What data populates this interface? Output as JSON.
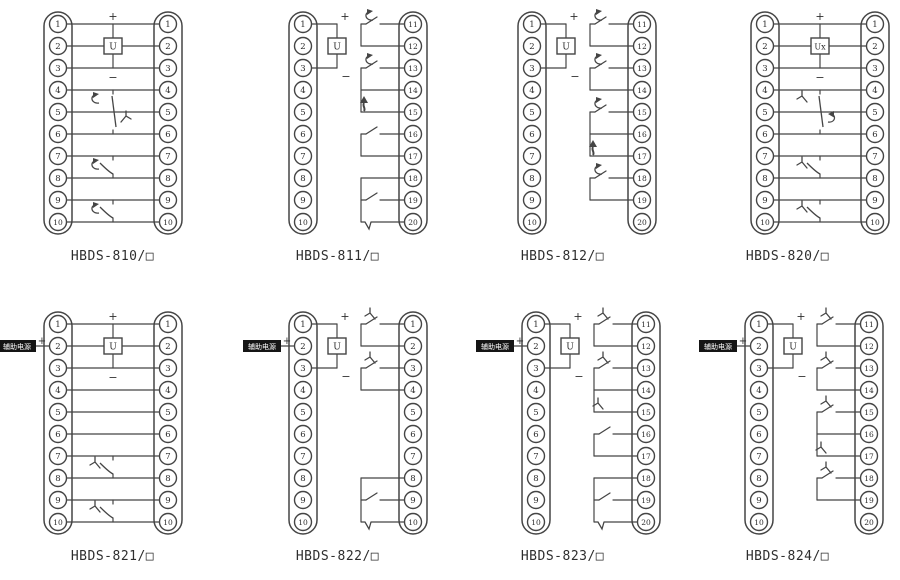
{
  "page": {
    "background": "#ffffff",
    "line_color": "#454545",
    "label_bg": "#151515",
    "label_fg": "#ffffff"
  },
  "diagrams": [
    {
      "title": "HBDS-810/□",
      "layout": "through",
      "x_shift": 0,
      "left_terminals": [
        "1",
        "2",
        "3",
        "4",
        "5",
        "6",
        "7",
        "8",
        "9",
        "10"
      ],
      "right_terminals": [
        "1",
        "2",
        "3",
        "4",
        "5",
        "6",
        "7",
        "8",
        "9",
        "10"
      ],
      "coil": {
        "label": "U",
        "plus": "+",
        "minus": "−"
      },
      "aux_label": null,
      "mid_contacts": [
        {
          "rows": [
            4,
            6
          ],
          "type": "changeover",
          "deco_top": "curl",
          "deco_mid": "fork"
        },
        {
          "rows": [
            7,
            8
          ],
          "type": "no",
          "deco_top": "curl"
        },
        {
          "rows": [
            9,
            10
          ],
          "type": "no",
          "deco_top": "curl"
        }
      ],
      "right_groups": []
    },
    {
      "title": "HBDS-811/□",
      "layout": "split",
      "x_shift": 0,
      "left_terminals": [
        "1",
        "2",
        "3",
        "4",
        "5",
        "6",
        "7",
        "8",
        "9",
        "10"
      ],
      "right_terminals": [
        "11",
        "12",
        "13",
        "14",
        "15",
        "16",
        "17",
        "18",
        "19",
        "20"
      ],
      "coil": {
        "label": "U",
        "plus": "+",
        "minus": "−"
      },
      "aux_label": null,
      "mid_contacts": [],
      "right_groups": [
        {
          "rows": [
            1,
            2
          ],
          "roles": [
            "contact-curl",
            "direct"
          ]
        },
        {
          "rows": [
            3,
            5
          ],
          "roles": [
            "contact-curl",
            "direct",
            "junction-bold"
          ]
        },
        {
          "rows": [
            6,
            7
          ],
          "roles": [
            "contact-plain",
            "direct"
          ]
        },
        {
          "rows": [
            8,
            10
          ],
          "roles": [
            "direct",
            "contact-plain",
            "hook"
          ]
        }
      ]
    },
    {
      "title": "HBDS-812/□",
      "layout": "split",
      "x_shift": 4,
      "left_terminals": [
        "1",
        "2",
        "3",
        "4",
        "5",
        "6",
        "7",
        "8",
        "9",
        "10"
      ],
      "right_terminals": [
        "11",
        "12",
        "13",
        "14",
        "15",
        "16",
        "17",
        "18",
        "19",
        "20"
      ],
      "coil": {
        "label": "U",
        "plus": "+",
        "minus": "−"
      },
      "aux_label": null,
      "mid_contacts": [],
      "right_groups": [
        {
          "rows": [
            1,
            2
          ],
          "roles": [
            "contact-curl",
            "direct"
          ]
        },
        {
          "rows": [
            3,
            4
          ],
          "roles": [
            "contact-curl",
            "direct"
          ]
        },
        {
          "rows": [
            5,
            7
          ],
          "roles": [
            "contact-curl",
            "direct",
            "junction-bold"
          ]
        },
        {
          "rows": [
            8,
            9
          ],
          "roles": [
            "contact-curl",
            "direct"
          ]
        }
      ]
    },
    {
      "title": "HBDS-820/□",
      "layout": "through",
      "x_shift": 32,
      "left_terminals": [
        "1",
        "2",
        "3",
        "4",
        "5",
        "6",
        "7",
        "8",
        "9",
        "10"
      ],
      "right_terminals": [
        "1",
        "2",
        "3",
        "4",
        "5",
        "6",
        "7",
        "8",
        "9",
        "10"
      ],
      "coil": {
        "label": "Ux",
        "plus": "+",
        "minus": "−"
      },
      "aux_label": null,
      "mid_contacts": [
        {
          "rows": [
            4,
            6
          ],
          "type": "changeover",
          "deco_top": "fork",
          "deco_mid": "curl"
        },
        {
          "rows": [
            7,
            8
          ],
          "type": "no",
          "deco_top": "fork"
        },
        {
          "rows": [
            9,
            10
          ],
          "type": "no",
          "deco_top": "fork"
        }
      ],
      "right_groups": []
    },
    {
      "title": "HBDS-821/□",
      "layout": "through",
      "x_shift": 0,
      "left_terminals": [
        "1",
        "2",
        "3",
        "4",
        "5",
        "6",
        "7",
        "8",
        "9",
        "10"
      ],
      "right_terminals": [
        "1",
        "2",
        "3",
        "4",
        "5",
        "6",
        "7",
        "8",
        "9",
        "10"
      ],
      "coil": {
        "label": "U",
        "plus": "+",
        "minus": "−"
      },
      "aux_label": {
        "text": "辅助电源",
        "plus": "+",
        "row": 2
      },
      "mid_contacts": [
        {
          "rows": [
            7,
            8
          ],
          "type": "no",
          "deco_top": "fork"
        },
        {
          "rows": [
            9,
            10
          ],
          "type": "no",
          "deco_top": "fork"
        }
      ],
      "right_groups": []
    },
    {
      "title": "HBDS-822/□",
      "layout": "split",
      "x_shift": 0,
      "left_terminals": [
        "1",
        "2",
        "3",
        "4",
        "5",
        "6",
        "7",
        "8",
        "9",
        "10"
      ],
      "right_terminals": [
        "1",
        "2",
        "3",
        "4",
        "5",
        "6",
        "7",
        "8",
        "9",
        "10"
      ],
      "coil": {
        "label": "U",
        "plus": "+",
        "minus": "−"
      },
      "aux_label": {
        "text": "辅助电源",
        "plus": "+",
        "row": 2
      },
      "mid_contacts": [],
      "right_groups": [
        {
          "rows": [
            1,
            2
          ],
          "roles": [
            "contact-fork",
            "direct"
          ]
        },
        {
          "rows": [
            3,
            4
          ],
          "roles": [
            "contact-fork",
            "direct"
          ]
        },
        {
          "rows": [
            8,
            10
          ],
          "roles": [
            "direct",
            "contact-plain",
            "hook"
          ]
        }
      ]
    },
    {
      "title": "HBDS-823/□",
      "layout": "split",
      "x_shift": 8,
      "left_terminals": [
        "1",
        "2",
        "3",
        "4",
        "5",
        "6",
        "7",
        "8",
        "9",
        "10"
      ],
      "right_terminals": [
        "11",
        "12",
        "13",
        "14",
        "15",
        "16",
        "17",
        "18",
        "19",
        "20"
      ],
      "coil": {
        "label": "U",
        "plus": "+",
        "minus": "−"
      },
      "aux_label": {
        "text": "辅助电源",
        "plus": "+",
        "row": 2
      },
      "mid_contacts": [],
      "right_groups": [
        {
          "rows": [
            1,
            2
          ],
          "roles": [
            "contact-fork",
            "direct"
          ]
        },
        {
          "rows": [
            3,
            5
          ],
          "roles": [
            "contact-fork",
            "direct",
            "junction-fork"
          ]
        },
        {
          "rows": [
            6,
            7
          ],
          "roles": [
            "contact-plain",
            "direct"
          ]
        },
        {
          "rows": [
            8,
            10
          ],
          "roles": [
            "direct",
            "contact-plain",
            "hook"
          ]
        }
      ]
    },
    {
      "title": "HBDS-824/□",
      "layout": "split",
      "x_shift": 6,
      "left_terminals": [
        "1",
        "2",
        "3",
        "4",
        "5",
        "6",
        "7",
        "8",
        "9",
        "10"
      ],
      "right_terminals": [
        "11",
        "12",
        "13",
        "14",
        "15",
        "16",
        "17",
        "18",
        "19",
        "20"
      ],
      "coil": {
        "label": "U",
        "plus": "+",
        "minus": "−"
      },
      "aux_label": {
        "text": "辅助电源",
        "plus": "+",
        "row": 2
      },
      "mid_contacts": [],
      "right_groups": [
        {
          "rows": [
            1,
            2
          ],
          "roles": [
            "contact-fork",
            "direct"
          ]
        },
        {
          "rows": [
            3,
            4
          ],
          "roles": [
            "contact-fork",
            "direct"
          ]
        },
        {
          "rows": [
            5,
            7
          ],
          "roles": [
            "contact-fork",
            "direct",
            "junction-fork"
          ]
        },
        {
          "rows": [
            8,
            9
          ],
          "roles": [
            "contact-fork",
            "direct"
          ]
        }
      ]
    }
  ]
}
